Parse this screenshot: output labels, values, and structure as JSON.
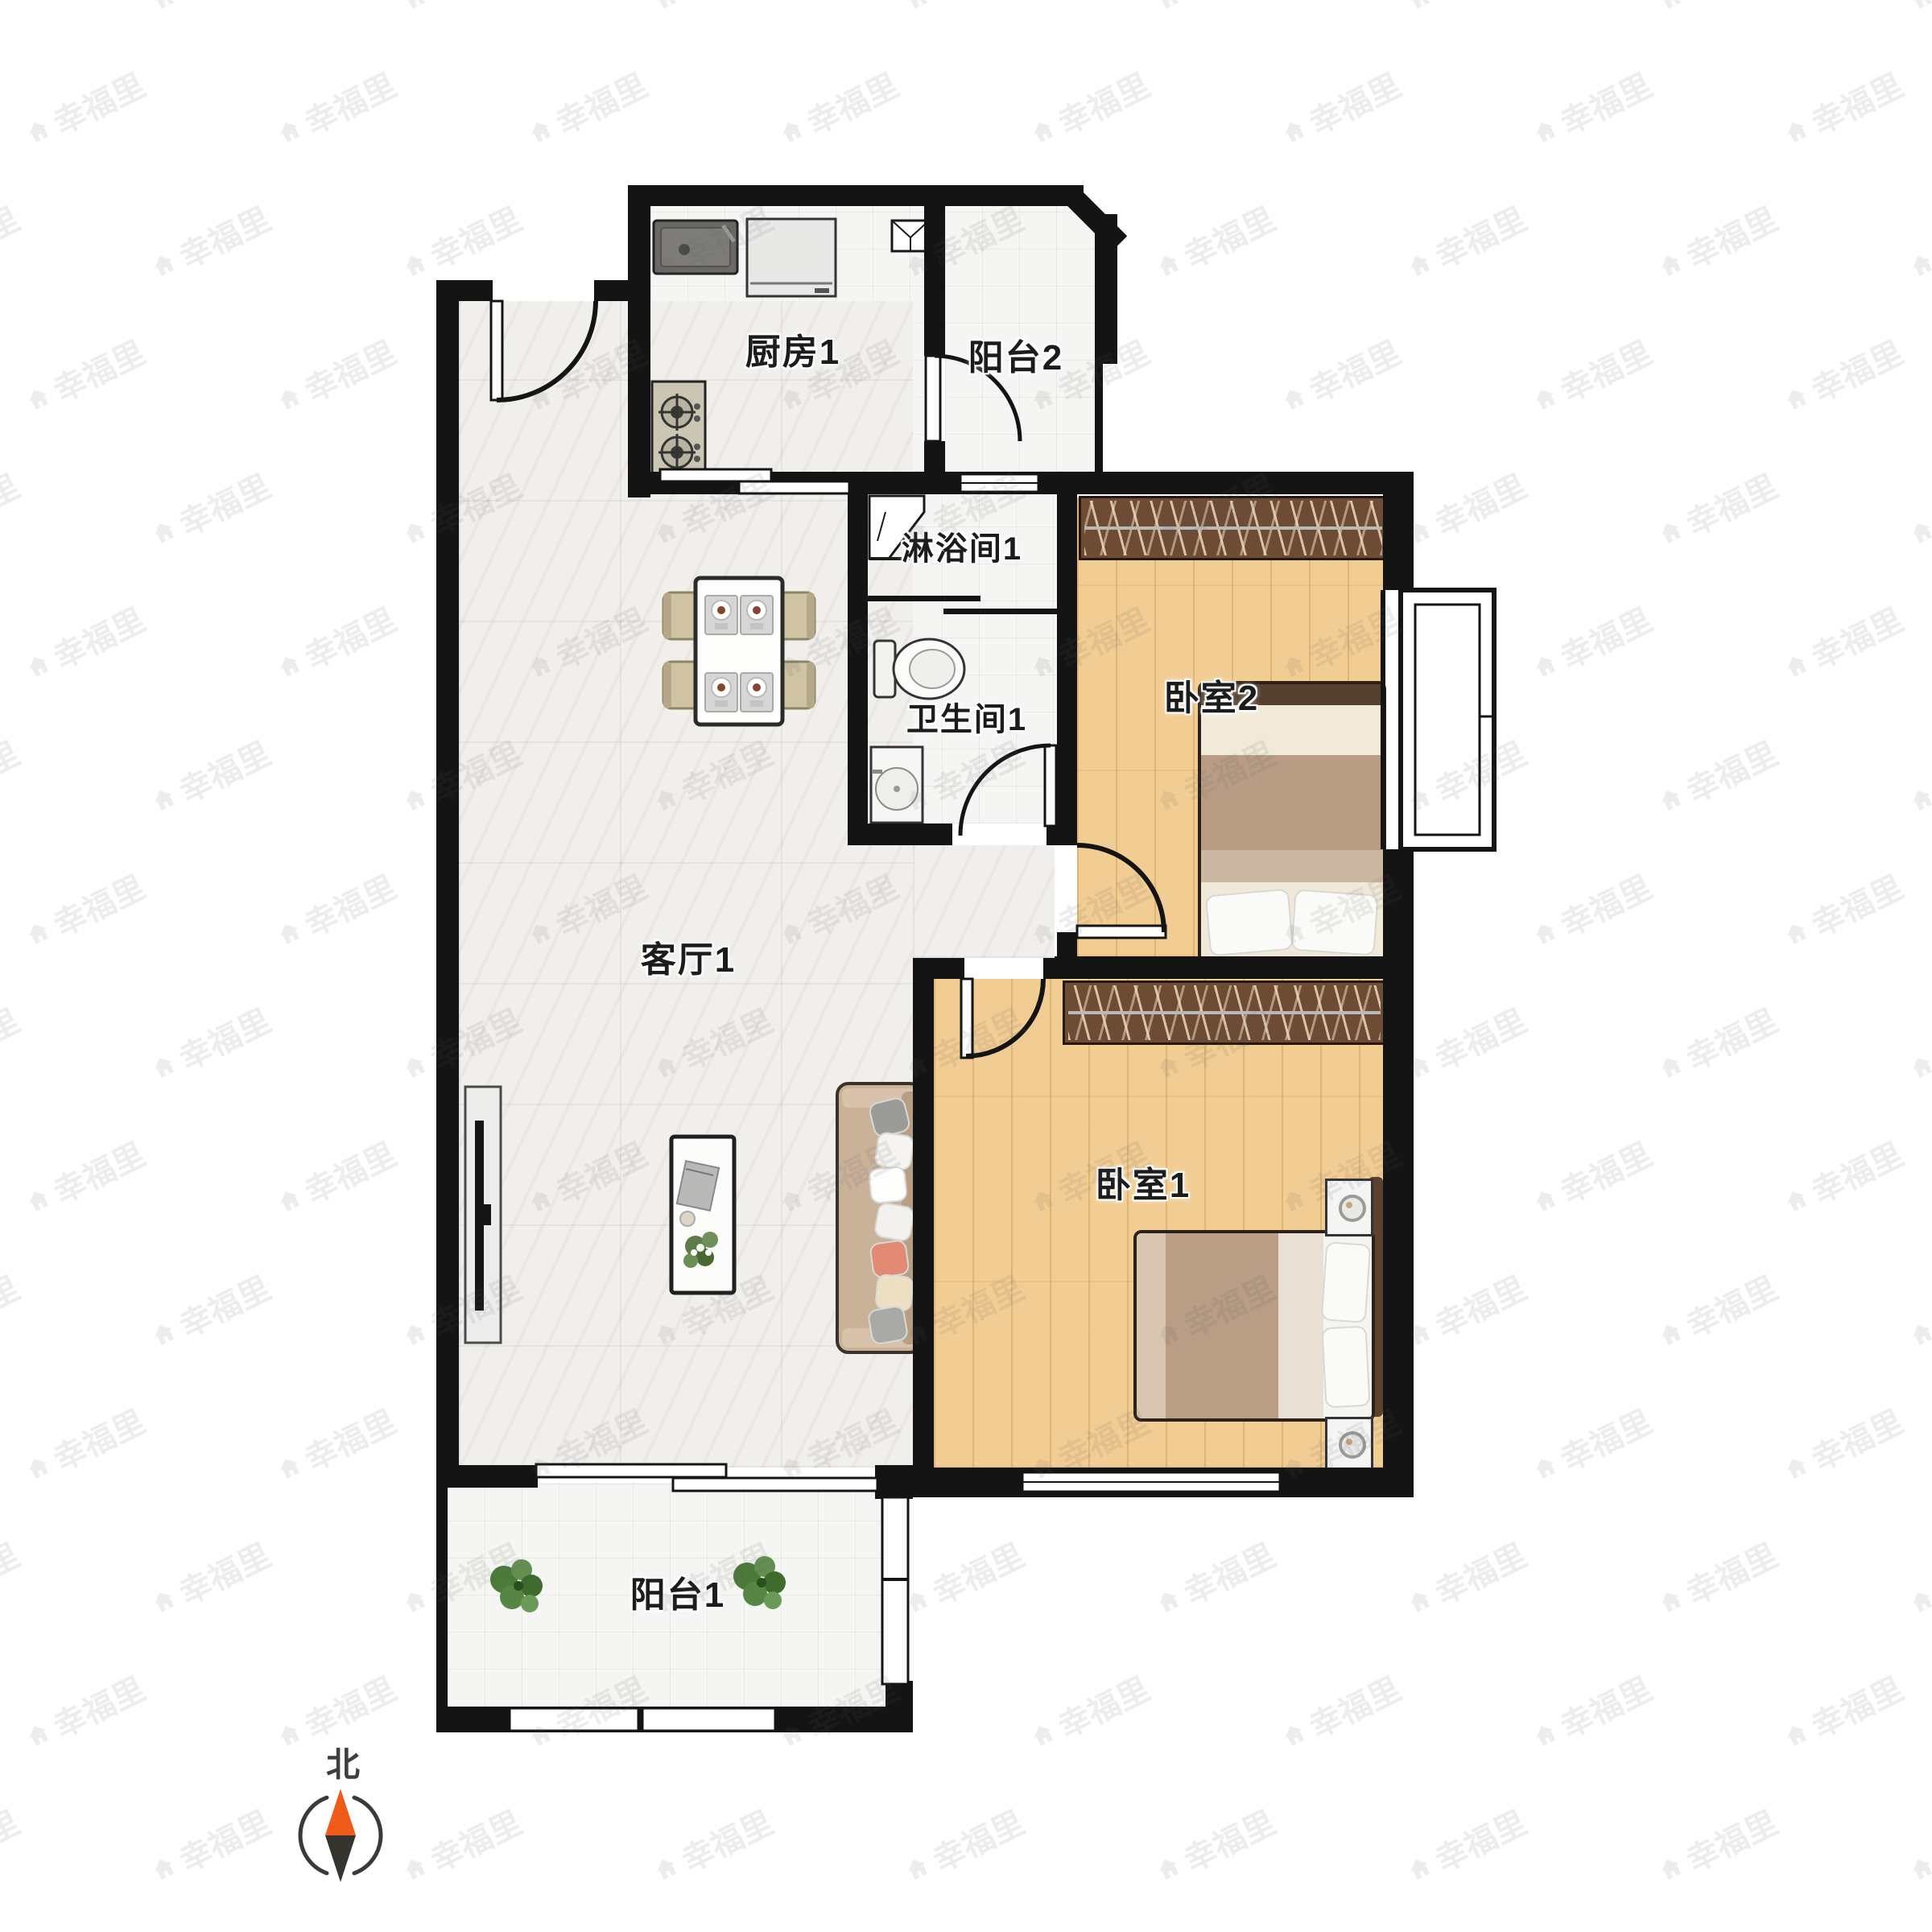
{
  "floorplan": {
    "rooms": {
      "kitchen": {
        "label": "厨房1",
        "furniture": [
          "sink",
          "fridge",
          "gas-stove",
          "sliding-door"
        ]
      },
      "balcony2": {
        "label": "阳台2",
        "furniture": [
          "utility-shaft",
          "swing-door"
        ]
      },
      "shower": {
        "label": "淋浴间1",
        "furniture": [
          "corner-shower-tray",
          "sliding-door"
        ]
      },
      "bathroom": {
        "label": "卫生间1",
        "furniture": [
          "toilet",
          "wash-basin",
          "swing-door"
        ]
      },
      "bedroom2": {
        "label": "卧室2",
        "furniture": [
          "wardrobe",
          "double-bed",
          "bay-window",
          "swing-door"
        ]
      },
      "living": {
        "label": "客厅1",
        "furniture": [
          "dining-table-4-chairs",
          "tv-cabinet",
          "coffee-table",
          "sofa",
          "entry-door"
        ]
      },
      "bedroom1": {
        "label": "卧室1",
        "furniture": [
          "wardrobe",
          "double-bed",
          "nightstand",
          "nightstand",
          "window",
          "swing-door"
        ]
      },
      "balcony1": {
        "label": "阳台1",
        "furniture": [
          "plant",
          "plant",
          "sliding-door",
          "windows"
        ]
      }
    },
    "compass": {
      "north_label": "北"
    },
    "watermark": {
      "text": "幸福里",
      "icon": "house-icon"
    },
    "colors": {
      "wall": "#141414",
      "wood_floor": "#f2cd93",
      "marble_floor": "#f1efec",
      "tile_floor": "#f5f5f3",
      "wardrobe": "#6d4b34",
      "sofa": "#cab299",
      "compass_north": "#f05a1a",
      "plant_green": "#4b7a39"
    }
  }
}
